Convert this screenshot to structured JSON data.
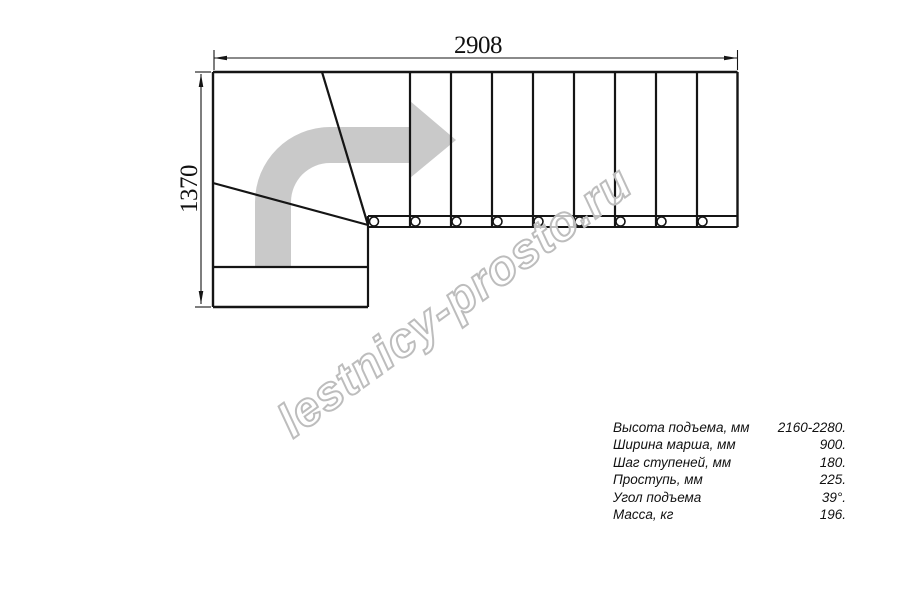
{
  "drawing": {
    "width_dimension": "2908",
    "height_dimension": "1370",
    "straight_tread_count": 9,
    "winder_tread_count": 3,
    "tread_line_xs": [
      410,
      451,
      492,
      533,
      574,
      615,
      656,
      697
    ],
    "baluster_xs": [
      374,
      415.5,
      456.5,
      497.5,
      538.5,
      579.5,
      620.5,
      661.5,
      702.5
    ]
  },
  "watermark": {
    "text": "lestnicy-prosto.ru"
  },
  "specs": {
    "rows": [
      {
        "label": "Высота подъема, мм",
        "value": "2160-2280."
      },
      {
        "label": "Ширина марша, мм",
        "value": "900."
      },
      {
        "label": "Шаг ступеней, мм",
        "value": "180."
      },
      {
        "label": "Проступь, мм",
        "value": "225."
      },
      {
        "label": "Угол подъема",
        "value": "39°."
      },
      {
        "label": "Масса, кг",
        "value": "196."
      }
    ]
  },
  "colors": {
    "line": "#151515",
    "direction_arrow": "#c9c9c9",
    "watermark_outline": "#bdbdbd",
    "text": "#111111"
  }
}
